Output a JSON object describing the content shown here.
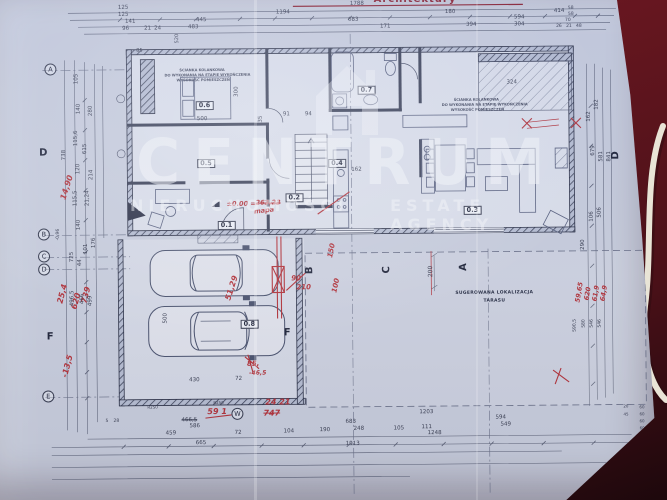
{
  "photo": {
    "surface_color": "#5c141d",
    "paper_color": "#cbd0df",
    "accent_red": "#b5353c",
    "cable": "white-cable"
  },
  "header": {
    "title": "Architektury"
  },
  "watermark": {
    "logo": "house-icon",
    "title": "CENTRUM",
    "subtitle_left": "NIERUCHOMOŚCI",
    "subtitle_right": "ESTATE AGENCY"
  },
  "terrace_note": {
    "line1": "SUGEROWANA LOKALIZACJA",
    "line2": "TARASU"
  },
  "bedroom_note": [
    "ŚCIANKA KOLANKOWA",
    "DO WYKONANIA NA ETAPIE WYKOŃCZENIA",
    "WYSOKOŚĆ POMIESZCZEŃ"
  ],
  "rooms": [
    "0.1",
    "0.2",
    "0.3",
    "0.4",
    "0.5",
    "0.6",
    "0.7",
    "0.8"
  ],
  "grid_letters": [
    "A",
    "B",
    "C",
    "D",
    "E"
  ],
  "section_letters": [
    "D",
    "F",
    "F",
    "B",
    "C",
    "A",
    "D",
    "W"
  ],
  "labels": [
    {
      "t": "A",
      "x": 46,
      "y": 61,
      "c": "gb",
      "n": "grid-bubble"
    },
    {
      "t": "B",
      "x": 38,
      "y": 226,
      "c": "gb",
      "n": "grid-bubble"
    },
    {
      "t": "C",
      "x": 38,
      "y": 248,
      "c": "gb",
      "n": "grid-bubble"
    },
    {
      "t": "D",
      "x": 38,
      "y": 261,
      "c": "gb",
      "n": "grid-bubble"
    },
    {
      "t": "E",
      "x": 41,
      "y": 388,
      "c": "gb",
      "n": "grid-bubble"
    },
    {
      "t": "W",
      "x": 230,
      "y": 407,
      "c": "gb",
      "n": "grid-bubble"
    },
    {
      "t": "D",
      "x": 40,
      "y": 146,
      "c": "sec",
      "n": "section-marker"
    },
    {
      "t": "F",
      "x": 46,
      "y": 330,
      "c": "sec",
      "n": "section-marker"
    },
    {
      "t": "F",
      "x": 283,
      "y": 328,
      "c": "sec",
      "n": "section-marker"
    },
    {
      "t": "B",
      "x": 305,
      "y": 274,
      "c": "sec",
      "r": -90,
      "n": "section-marker"
    },
    {
      "t": "C",
      "x": 382,
      "y": 274,
      "c": "sec",
      "r": -90,
      "n": "section-marker"
    },
    {
      "t": "A",
      "x": 459,
      "y": 272,
      "c": "sec",
      "r": -90,
      "n": "section-marker"
    },
    {
      "t": "D",
      "x": 612,
      "y": 162,
      "c": "sec",
      "r": -90,
      "n": "section-marker"
    },
    {
      "t": "0.6",
      "x": 197,
      "y": 100,
      "c": "room",
      "n": "room-label"
    },
    {
      "t": "0.5",
      "x": 198,
      "y": 158,
      "c": "room",
      "n": "room-label"
    },
    {
      "t": "0.7",
      "x": 359,
      "y": 86,
      "c": "room",
      "n": "room-label"
    },
    {
      "t": "0.4",
      "x": 329,
      "y": 159,
      "c": "room",
      "n": "room-label"
    },
    {
      "t": "0.2",
      "x": 286,
      "y": 193,
      "c": "room",
      "n": "room-label"
    },
    {
      "t": "0.1",
      "x": 218,
      "y": 220,
      "c": "room",
      "n": "room-label"
    },
    {
      "t": "0.3",
      "x": 464,
      "y": 207,
      "c": "room",
      "n": "room-label"
    },
    {
      "t": "0.8",
      "x": 240,
      "y": 319,
      "c": "room",
      "n": "room-label"
    },
    {
      "t": "14,90",
      "x": 60,
      "y": 196,
      "c": "red",
      "r": -72,
      "n": "red-annotation"
    },
    {
      "t": "25,4",
      "x": 56,
      "y": 300,
      "c": "red",
      "r": -75,
      "n": "red-annotation"
    },
    {
      "t": "620",
      "x": 70,
      "y": 306,
      "c": "red",
      "r": -75,
      "n": "red-annotation"
    },
    {
      "t": "739",
      "x": 80,
      "y": 300,
      "c": "red",
      "r": -75,
      "n": "red-annotation"
    },
    {
      "t": "-13,5",
      "x": 60,
      "y": 374,
      "c": "red",
      "r": -75,
      "n": "red-annotation"
    },
    {
      "t": "±0.00 =",
      "x": 227,
      "y": 200,
      "c": "red",
      "s": 6.5,
      "n": "red-annotation"
    },
    {
      "t": "263,23",
      "x": 256,
      "y": 199,
      "c": "red",
      "s": 6.5,
      "k": 1,
      "n": "red-annotation"
    },
    {
      "t": "mapa",
      "x": 254,
      "y": 208,
      "c": "red",
      "r": -6,
      "s": 6.5,
      "n": "red-annotation"
    },
    {
      "t": "90",
      "x": 291,
      "y": 275,
      "c": "red",
      "s": 7,
      "n": "red-annotation"
    },
    {
      "t": "210",
      "x": 296,
      "y": 284,
      "c": "red",
      "s": 7,
      "n": "red-annotation"
    },
    {
      "t": "150",
      "x": 327,
      "y": 257,
      "c": "red",
      "r": -78,
      "s": 7,
      "n": "red-annotation"
    },
    {
      "t": "100",
      "x": 331,
      "y": 292,
      "c": "red",
      "r": -78,
      "s": 7,
      "n": "red-annotation"
    },
    {
      "t": "51,29",
      "x": 224,
      "y": 298,
      "c": "red",
      "r": -72,
      "n": "red-annotation"
    },
    {
      "t": "85,",
      "x": 246,
      "y": 360,
      "c": "red",
      "s": 7,
      "n": "red-annotation"
    },
    {
      "t": "-46,5",
      "x": 248,
      "y": 370,
      "c": "red",
      "s": 6,
      "n": "red-annotation"
    },
    {
      "t": "59 1",
      "x": 206,
      "y": 407,
      "c": "red",
      "s": 8,
      "n": "red-annotation"
    },
    {
      "t": "24 21",
      "x": 264,
      "y": 398,
      "c": "red",
      "s": 8,
      "n": "red-annotation"
    },
    {
      "t": "747",
      "x": 262,
      "y": 409,
      "c": "red",
      "s": 8,
      "k": 1,
      "n": "red-annotation"
    },
    {
      "t": "59,65",
      "x": 574,
      "y": 304,
      "c": "red",
      "r": -80,
      "s": 6.5,
      "n": "red-annotation"
    },
    {
      "t": "620",
      "x": 583,
      "y": 302,
      "c": "red",
      "r": -80,
      "s": 6.5,
      "n": "red-annotation"
    },
    {
      "t": "61,9",
      "x": 591,
      "y": 303,
      "c": "red",
      "r": -80,
      "s": 6.5,
      "n": "red-annotation"
    },
    {
      "t": "64,9",
      "x": 599,
      "y": 303,
      "c": "red",
      "r": -80,
      "s": 6.5,
      "n": "red-annotation"
    },
    {
      "t": "125",
      "x": 120,
      "y": 4,
      "n": "dim-label"
    },
    {
      "t": "125",
      "x": 120,
      "y": 11,
      "n": "dim-label"
    },
    {
      "t": "141",
      "x": 127,
      "y": 18,
      "n": "dim-label"
    },
    {
      "t": "96",
      "x": 124,
      "y": 25,
      "n": "dim-label"
    },
    {
      "t": "21",
      "x": 146,
      "y": 25,
      "n": "dim-label"
    },
    {
      "t": "24",
      "x": 156,
      "y": 25,
      "n": "dim-label"
    },
    {
      "t": "445",
      "x": 198,
      "y": 17,
      "n": "dim-label"
    },
    {
      "t": "483",
      "x": 190,
      "y": 24,
      "n": "dim-label"
    },
    {
      "t": "1194",
      "x": 278,
      "y": 10,
      "n": "dim-label"
    },
    {
      "t": "1788",
      "x": 352,
      "y": 2,
      "n": "dim-label"
    },
    {
      "t": "683",
      "x": 350,
      "y": 18,
      "n": "dim-label"
    },
    {
      "t": "171",
      "x": 382,
      "y": 25,
      "n": "dim-label"
    },
    {
      "t": "180",
      "x": 447,
      "y": 11,
      "n": "dim-label"
    },
    {
      "t": "594",
      "x": 516,
      "y": 17,
      "n": "dim-label"
    },
    {
      "t": "414",
      "x": 556,
      "y": 11,
      "n": "dim-label"
    },
    {
      "t": "304",
      "x": 516,
      "y": 24,
      "n": "dim-label"
    },
    {
      "t": "394",
      "x": 468,
      "y": 24,
      "n": "dim-label"
    },
    {
      "t": "58",
      "x": 570,
      "y": 9,
      "s": 4.5,
      "n": "dim-label"
    },
    {
      "t": "58",
      "x": 570,
      "y": 15,
      "s": 4.5,
      "n": "dim-label"
    },
    {
      "t": "70",
      "x": 567,
      "y": 21,
      "s": 4.5,
      "n": "dim-label"
    },
    {
      "t": "26",
      "x": 558,
      "y": 27,
      "s": 4.5,
      "n": "dim-label"
    },
    {
      "t": "21",
      "x": 568,
      "y": 27,
      "s": 4.5,
      "n": "dim-label"
    },
    {
      "t": "48",
      "x": 578,
      "y": 27,
      "s": 4.5,
      "n": "dim-label"
    },
    {
      "t": "85",
      "x": 138,
      "y": 47,
      "s": 5,
      "n": "dim-label"
    },
    {
      "t": "520",
      "x": 177,
      "y": 42,
      "r": -90,
      "s": 5,
      "n": "dim-label"
    },
    {
      "t": "500",
      "x": 198,
      "y": 116,
      "n": "dim-label"
    },
    {
      "t": "300",
      "x": 236,
      "y": 96,
      "r": -90,
      "n": "dim-label"
    },
    {
      "t": "35",
      "x": 260,
      "y": 122,
      "r": -90,
      "n": "dim-label"
    },
    {
      "t": "91",
      "x": 284,
      "y": 112,
      "n": "dim-label"
    },
    {
      "t": "94",
      "x": 306,
      "y": 112,
      "n": "dim-label"
    },
    {
      "t": "324",
      "x": 508,
      "y": 82,
      "n": "dim-label"
    },
    {
      "t": "162",
      "x": 352,
      "y": 168,
      "n": "dim-label"
    },
    {
      "t": "105",
      "x": 76,
      "y": 82,
      "r": -90,
      "n": "dim-label"
    },
    {
      "t": "140",
      "x": 78,
      "y": 112,
      "r": -90,
      "n": "dim-label"
    },
    {
      "t": "280",
      "x": 90,
      "y": 114,
      "r": -90,
      "n": "dim-label"
    },
    {
      "t": "115,6",
      "x": 75,
      "y": 144,
      "r": -90,
      "n": "dim-label"
    },
    {
      "t": "738",
      "x": 63,
      "y": 158,
      "r": -90,
      "n": "dim-label"
    },
    {
      "t": "615",
      "x": 84,
      "y": 152,
      "r": -90,
      "n": "dim-label"
    },
    {
      "t": "120",
      "x": 77,
      "y": 172,
      "r": -90,
      "n": "dim-label"
    },
    {
      "t": "214",
      "x": 90,
      "y": 178,
      "r": -90,
      "n": "dim-label"
    },
    {
      "t": "115,5",
      "x": 74,
      "y": 204,
      "r": -90,
      "n": "dim-label"
    },
    {
      "t": "21,24",
      "x": 86,
      "y": 204,
      "r": -90,
      "n": "dim-label"
    },
    {
      "t": "140",
      "x": 77,
      "y": 228,
      "r": -90,
      "n": "dim-label"
    },
    {
      "t": "-0,96",
      "x": 57,
      "y": 238,
      "r": -90,
      "s": 4.5,
      "n": "dim-label"
    },
    {
      "t": "176",
      "x": 92,
      "y": 246,
      "r": -90,
      "n": "dim-label"
    },
    {
      "t": "101",
      "x": 84,
      "y": 252,
      "r": -90,
      "n": "dim-label"
    },
    {
      "t": "725",
      "x": 70,
      "y": 260,
      "r": -90,
      "n": "dim-label"
    },
    {
      "t": "44",
      "x": 78,
      "y": 264,
      "r": -90,
      "n": "dim-label"
    },
    {
      "t": "496,5",
      "x": 70,
      "y": 304,
      "r": -90,
      "n": "dim-label"
    },
    {
      "t": "466",
      "x": 80,
      "y": 302,
      "r": -90,
      "n": "dim-label"
    },
    {
      "t": "499",
      "x": 88,
      "y": 304,
      "r": -90,
      "n": "dim-label"
    },
    {
      "t": "182",
      "x": 596,
      "y": 112,
      "r": -90,
      "n": "dim-label"
    },
    {
      "t": "162",
      "x": 588,
      "y": 124,
      "r": -90,
      "n": "dim-label"
    },
    {
      "t": "679",
      "x": 592,
      "y": 158,
      "r": -90,
      "n": "dim-label"
    },
    {
      "t": "581",
      "x": 600,
      "y": 164,
      "r": -90,
      "n": "dim-label"
    },
    {
      "t": "841",
      "x": 608,
      "y": 164,
      "r": -90,
      "n": "dim-label"
    },
    {
      "t": "106",
      "x": 590,
      "y": 224,
      "r": -90,
      "n": "dim-label"
    },
    {
      "t": "506",
      "x": 598,
      "y": 220,
      "r": -90,
      "n": "dim-label"
    },
    {
      "t": "590,5",
      "x": 573,
      "y": 334,
      "r": -90,
      "s": 4.5,
      "n": "dim-label"
    },
    {
      "t": "580",
      "x": 582,
      "y": 330,
      "r": -90,
      "s": 4.5,
      "n": "dim-label"
    },
    {
      "t": "546",
      "x": 590,
      "y": 330,
      "r": -90,
      "s": 4.5,
      "n": "dim-label"
    },
    {
      "t": "546",
      "x": 598,
      "y": 330,
      "r": -90,
      "s": 4.5,
      "n": "dim-label"
    },
    {
      "t": "200",
      "x": 428,
      "y": 278,
      "r": -90,
      "s": 6,
      "n": "dim-label"
    },
    {
      "t": "290",
      "x": 581,
      "y": 252,
      "r": -90,
      "n": "dim-label"
    },
    {
      "t": "430",
      "x": 188,
      "y": 377,
      "n": "dim-label"
    },
    {
      "t": "500",
      "x": 163,
      "y": 322,
      "r": -90,
      "n": "dim-label"
    },
    {
      "t": "72",
      "x": 234,
      "y": 376,
      "n": "dim-label"
    },
    {
      "t": "R250",
      "x": 146,
      "y": 404,
      "s": 4,
      "n": "dim-label"
    },
    {
      "t": "R250",
      "x": 212,
      "y": 400,
      "s": 4,
      "n": "dim-label"
    },
    {
      "t": "5",
      "x": 104,
      "y": 418,
      "s": 4.5,
      "n": "dim-label"
    },
    {
      "t": "28",
      "x": 112,
      "y": 418,
      "s": 4.5,
      "n": "dim-label"
    },
    {
      "t": "466,5",
      "x": 180,
      "y": 417,
      "k": 1,
      "n": "dim-label"
    },
    {
      "t": "586",
      "x": 188,
      "y": 423,
      "n": "dim-label"
    },
    {
      "t": "459",
      "x": 164,
      "y": 430,
      "n": "dim-label"
    },
    {
      "t": "72",
      "x": 233,
      "y": 430,
      "n": "dim-label"
    },
    {
      "t": "104",
      "x": 282,
      "y": 429,
      "n": "dim-label"
    },
    {
      "t": "190",
      "x": 318,
      "y": 428,
      "n": "dim-label"
    },
    {
      "t": "248",
      "x": 352,
      "y": 427,
      "n": "dim-label"
    },
    {
      "t": "105",
      "x": 392,
      "y": 427,
      "n": "dim-label"
    },
    {
      "t": "111",
      "x": 420,
      "y": 426,
      "n": "dim-label"
    },
    {
      "t": "683",
      "x": 344,
      "y": 420,
      "n": "dim-label"
    },
    {
      "t": "1203",
      "x": 418,
      "y": 411,
      "n": "dim-label"
    },
    {
      "t": "594",
      "x": 494,
      "y": 417,
      "n": "dim-label"
    },
    {
      "t": "549",
      "x": 499,
      "y": 424,
      "n": "dim-label"
    },
    {
      "t": "1248",
      "x": 426,
      "y": 432,
      "n": "dim-label"
    },
    {
      "t": "665",
      "x": 194,
      "y": 440,
      "n": "dim-label"
    },
    {
      "t": "1913",
      "x": 344,
      "y": 442,
      "n": "dim-label"
    },
    {
      "t": "20",
      "x": 622,
      "y": 407,
      "s": 4,
      "n": "dim-label"
    },
    {
      "t": "45",
      "x": 622,
      "y": 415,
      "s": 4,
      "n": "dim-label"
    },
    {
      "t": "60",
      "x": 638,
      "y": 408,
      "s": 4,
      "n": "dim-label"
    },
    {
      "t": "60",
      "x": 638,
      "y": 415,
      "s": 4,
      "n": "dim-label"
    },
    {
      "t": "60",
      "x": 638,
      "y": 422,
      "s": 4,
      "n": "dim-label"
    },
    {
      "t": "60",
      "x": 638,
      "y": 429,
      "s": 4,
      "n": "dim-label"
    },
    {
      "t": "ŚCIANKA KOLANKOWA",
      "x": 181,
      "y": 68,
      "c": "tinynote",
      "n": "note-label"
    },
    {
      "t": "DO WYKONANIA NA ETAPIE WYKOŃCZENIA",
      "x": 166,
      "y": 73,
      "c": "tinynote",
      "n": "note-label"
    },
    {
      "t": "WYSOKOŚĆ POMIESZCZEŃ",
      "x": 178,
      "y": 78,
      "c": "tinynote",
      "n": "note-label"
    },
    {
      "t": "ŚCIANKA KOLANKOWA",
      "x": 455,
      "y": 100,
      "c": "tinynote",
      "n": "note-label"
    },
    {
      "t": "DO WYKONANIA NA ETAPIE WYKOŃCZENIA",
      "x": 443,
      "y": 105,
      "c": "tinynote",
      "n": "note-label"
    },
    {
      "t": "WYSOKOŚĆ POMIESZCZEŃ",
      "x": 452,
      "y": 110,
      "c": "tinynote",
      "n": "note-label"
    },
    {
      "t": "SUGEROWANA LOKALIZACJA",
      "x": 455,
      "y": 293,
      "c": "note",
      "n": "terrace-note"
    },
    {
      "t": "TARASU",
      "x": 483,
      "y": 301,
      "c": "note",
      "n": "terrace-note"
    }
  ]
}
